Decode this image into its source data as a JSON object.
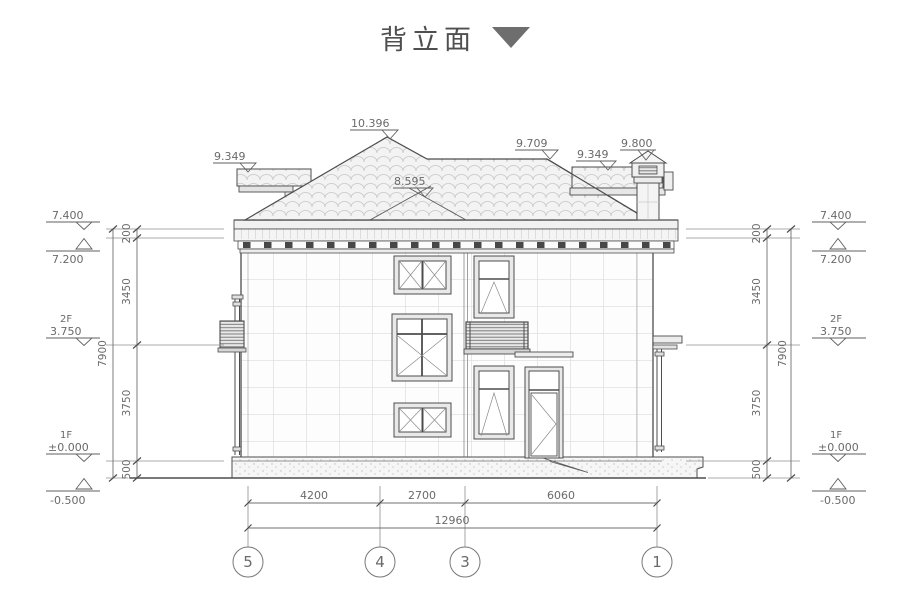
{
  "title": {
    "text": "背立面"
  },
  "roof_markers": {
    "ridge": "10.396",
    "left_eave": "9.349",
    "mid_ridge": "8.595",
    "upper_right": "9.709",
    "right_band": "9.349",
    "chimney": "9.800"
  },
  "levels": {
    "parapet": {
      "label": "7.400"
    },
    "eave": {
      "label": "7.200"
    },
    "floor2": {
      "name": "2F",
      "label": "3.750"
    },
    "floor1": {
      "name": "1F",
      "label": "±0.000"
    },
    "ground": {
      "label": "-0.500"
    }
  },
  "vertical_dims": {
    "seg1": "200",
    "seg2": "3450",
    "seg3": "3750",
    "seg4": "500",
    "total": "7900"
  },
  "bottom_dims": {
    "seg1": "4200",
    "seg2": "2700",
    "seg3": "6060",
    "total": "12960"
  },
  "axes": {
    "a5": "5",
    "a4": "4",
    "a3": "3",
    "a1": "1"
  }
}
